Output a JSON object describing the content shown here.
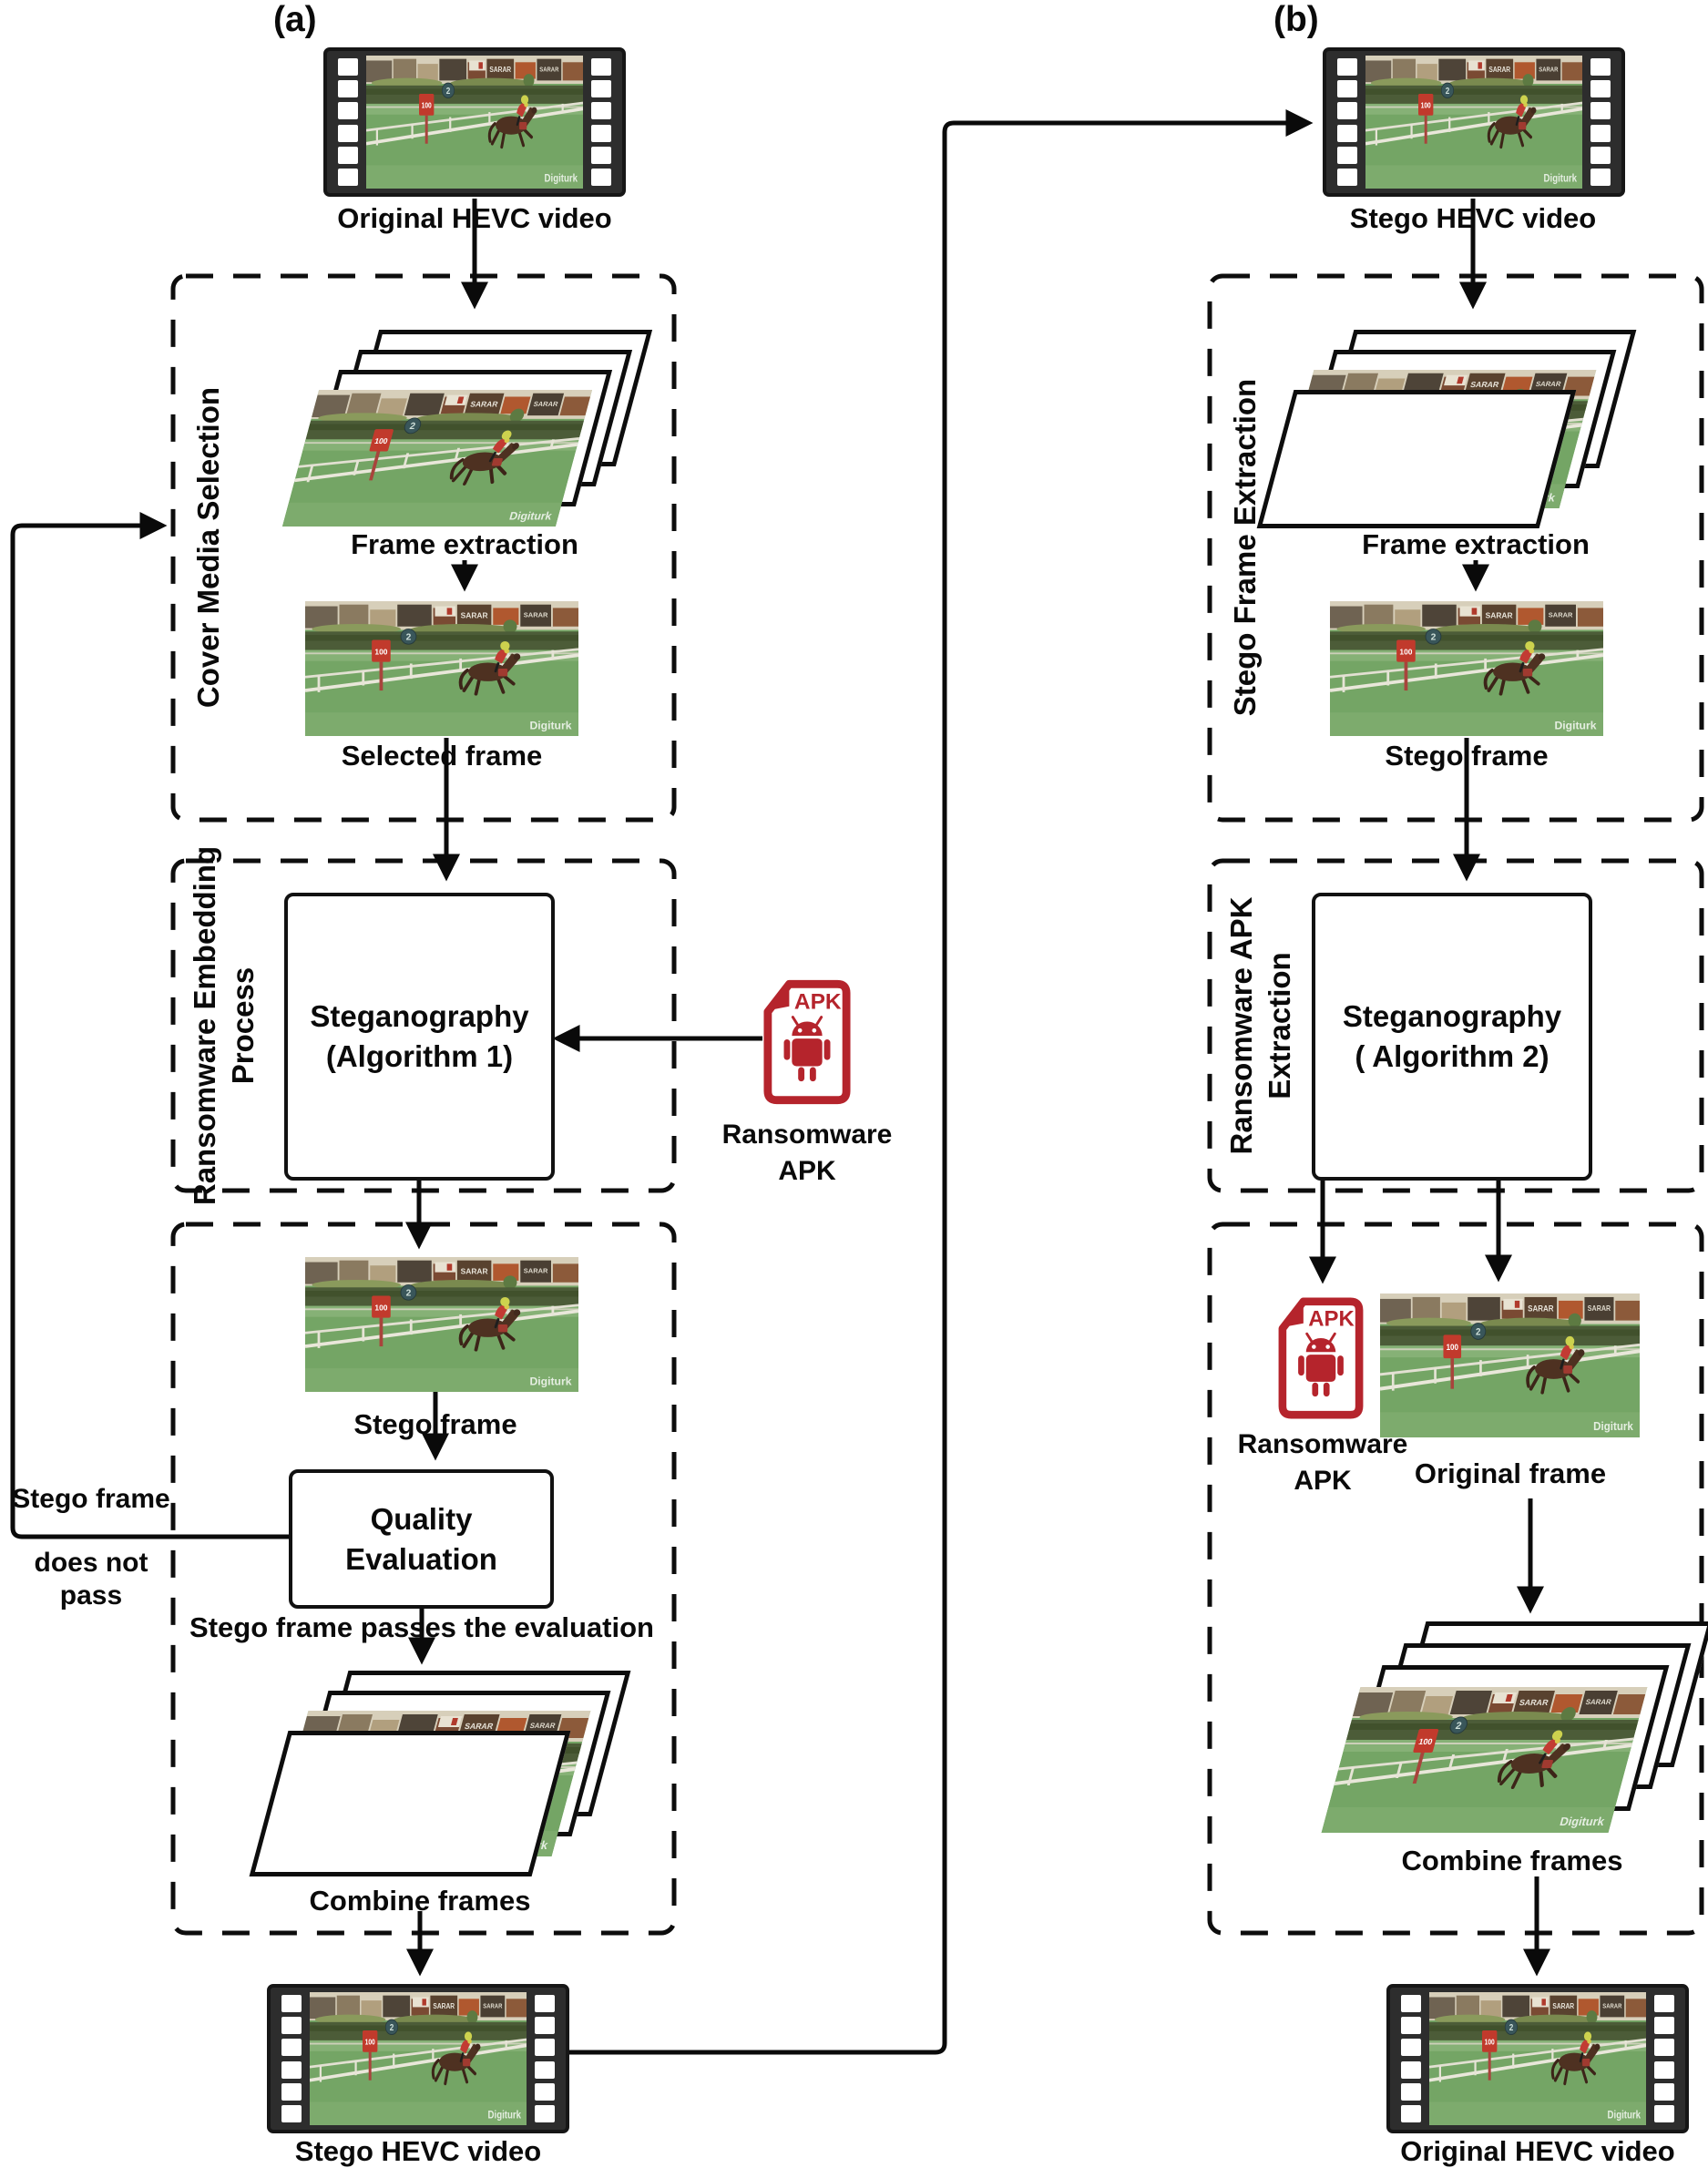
{
  "figure": {
    "panel_a_label": "(a)",
    "panel_b_label": "(b)",
    "watermark": "Digiturk"
  },
  "scene": {
    "billboard_text": "SARAR",
    "billboard_text_2": "SARAR",
    "distance_sign": "100",
    "gate_sign": "2"
  },
  "apk_icon": {
    "file_label": "APK"
  },
  "panel_a": {
    "top_video_label": "Original HEVC video",
    "cover_media_selection": {
      "title": "Cover Media Selection",
      "frame_extraction_label": "Frame extraction",
      "selected_frame_label": "Selected  frame"
    },
    "embedding": {
      "title": "Ransomware Embedding\nProcess",
      "steganography_box": "Steganography\n(Algorithm 1)",
      "ransomware_apk_label": "Ransomware\nAPK"
    },
    "evaluation": {
      "stego_frame_label": "Stego frame",
      "quality_evaluation_box": "Quality Evaluation",
      "pass_label": "Stego frame passes the evaluation",
      "fail_label_line1": "Stego frame",
      "fail_label_line2": "does not pass",
      "combine_frames_label": "Combine frames"
    },
    "bottom_video_label": "Stego HEVC video"
  },
  "panel_b": {
    "top_video_label": "Stego HEVC video",
    "stego_frame_extraction": {
      "title": "Stego Frame Extraction",
      "frame_extraction_label": "Frame extraction",
      "stego_frame_label": "Stego frame"
    },
    "apk_extraction": {
      "title": "Ransomware APK\nExtraction",
      "steganography_box": "Steganography\n( Algorithm 2)"
    },
    "reconstruction": {
      "ransomware_apk_label": "Ransomware\nAPK",
      "original_frame_label": "Original frame",
      "combine_frames_label": "Combine frames"
    },
    "bottom_video_label": "Original HEVC video"
  },
  "colors": {
    "accent_red": "#b5242c",
    "line": "#0a0a0a"
  }
}
